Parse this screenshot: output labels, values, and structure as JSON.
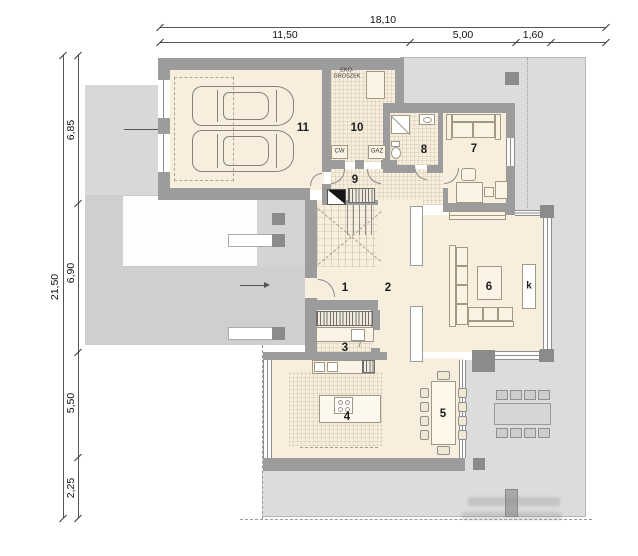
{
  "dimensions": {
    "top": {
      "total": "18,10",
      "segments": [
        "11,50",
        "5,00",
        "1,60"
      ]
    },
    "left": {
      "total": "21,50",
      "segments": [
        "6,85",
        "6,90",
        "5,50",
        "2,25"
      ]
    }
  },
  "rooms": {
    "r1": "1",
    "r2": "2",
    "r3": "3",
    "r4": "4",
    "r5": "5",
    "r6": "6",
    "r7": "7",
    "r8": "8",
    "r9": "9",
    "r10": "10",
    "r11": "11",
    "fireplace": "k"
  },
  "equipment": {
    "fuel_store": "EKO-GROSZEK",
    "hot_water": "CW",
    "gas": "GAZ"
  },
  "colors": {
    "wall": "#9c9c9c",
    "floor": "#f8eedd",
    "paving": "#dcdcdc",
    "driveway": "#cfcfcf",
    "column": "#8b8b8b"
  }
}
